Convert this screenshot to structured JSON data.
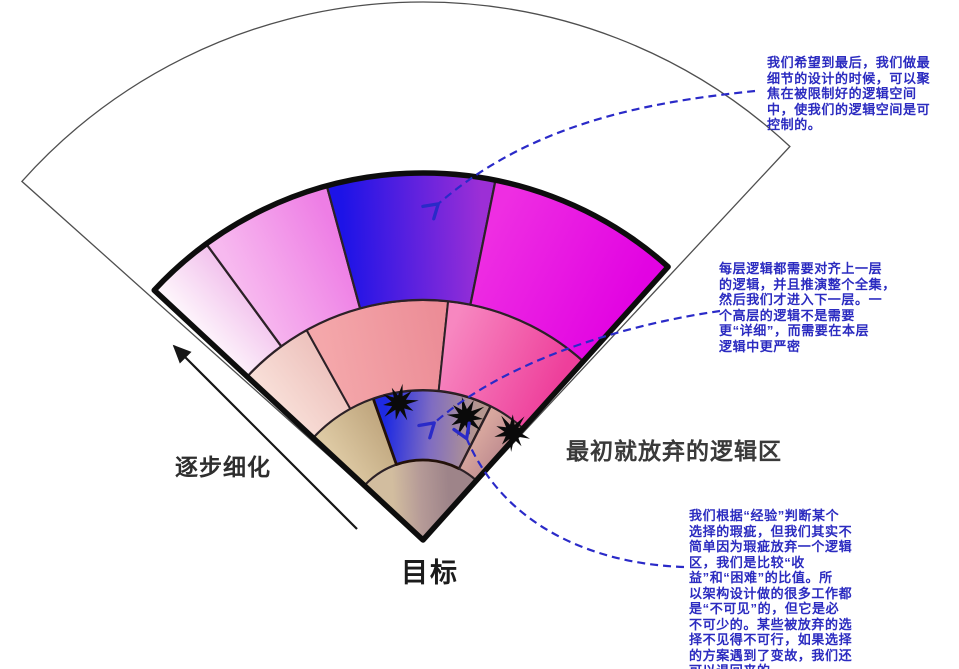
{
  "labels": {
    "refine": "逐步细化",
    "goal": "目标",
    "abandoned": "最初就放弃的逻辑区"
  },
  "annotations": [
    {
      "text": "我们希望到最后，我们做最\n细节的设计的时候，可以聚\n焦在被限制好的逻辑空间\n中，使我们的逻辑空间是可\n控制的。"
    },
    {
      "text": "每层逻辑都需要对齐上一层\n的逻辑，并且推演整个全集，\n然后我们才进入下一层。一\n个高层的逻辑不是需要\n更“详细”，而需要在本层\n逻辑中更严密"
    },
    {
      "text": "我们根据“经验”判断某个\n选择的瑕疵，但我们其实不\n简单因为瑕疵放弃一个逻辑\n区，我们是比较“收\n益”和“困难”的比值。所\n以架构设计做的很多工作都\n是“不可见”的，但它是必\n不可少的。某些被放弃的选\n择不见得不可行，如果选择\n的方案遇到了变故，我们还\n可以退回来的。"
    }
  ],
  "colors": {
    "annotation_blue": "#2b2bc0",
    "callout_dash_blue": "#2a2ac8",
    "fan_outline_black": "#0d0d0d",
    "white_fan_stroke": "#4f4f4f"
  },
  "diagram": {
    "apex": {
      "x": 423,
      "y": 540
    },
    "white_fan": {
      "a0": 47.0,
      "a1": 138.2,
      "r": 538,
      "fill": "#ffffff",
      "stroke": "#4f4f4f",
      "stroke_width": 1.3
    },
    "fan": {
      "a0": 48.1,
      "a1": 137.1,
      "r_outer": 367,
      "outline_color": "#0d0d0d",
      "outline_width": 5.5
    },
    "rings": [
      {
        "r_inner": 0,
        "r_outer": 80,
        "stroke": "#2c2127",
        "stroke_width": 2,
        "segments": [
          {
            "a0": 48.1,
            "a1": 137.1,
            "stops": [
              "#d2bd9f",
              "#b59a97",
              "#9e8489"
            ]
          }
        ]
      },
      {
        "r_inner": 80,
        "r_outer": 150,
        "stroke": "#2c2127",
        "stroke_width": 2,
        "segments": [
          {
            "a0": 109.4,
            "a1": 137.1,
            "stops": [
              "#ddc9a3",
              "#c2a981"
            ]
          },
          {
            "a0": 63.1,
            "a1": 109.4,
            "stops": [
              "#1e2ae2",
              "#7f6cc2",
              "#b4968f"
            ],
            "outline": {
              "color": "#231109",
              "width": 2.8
            }
          },
          {
            "a0": 48.1,
            "a1": 63.1,
            "stops": [
              "#d8a79e",
              "#c18e91"
            ]
          }
        ]
      },
      {
        "r_inner": 150,
        "r_outer": 240,
        "stroke": "#2c2127",
        "stroke_width": 2,
        "segments": [
          {
            "a0": 119.0,
            "a1": 137.1,
            "stops": [
              "#f8ded7",
              "#eec4bf"
            ]
          },
          {
            "a0": 84.0,
            "a1": 119.0,
            "stops": [
              "#f4a7aa",
              "#ec8d97"
            ]
          },
          {
            "a0": 48.1,
            "a1": 84.0,
            "stops": [
              "#f787c0",
              "#ee3f9b"
            ]
          }
        ]
      },
      {
        "r_inner": 240,
        "r_outer": 367,
        "stroke": "#2c2127",
        "stroke_width": 2.2,
        "segments": [
          {
            "a0": 126.2,
            "a1": 137.1,
            "stops": [
              "#fdf4fb",
              "#f3c6ee"
            ]
          },
          {
            "a0": 105.2,
            "a1": 126.2,
            "stops": [
              "#f7b9ef",
              "#ee7ee5"
            ]
          },
          {
            "a0": 78.6,
            "a1": 105.2,
            "stops": [
              "#1d13e7",
              "#9c2fd6"
            ]
          },
          {
            "a0": 48.1,
            "a1": 78.6,
            "stops": [
              "#ee2ee2",
              "#e203e2"
            ]
          }
        ]
      }
    ],
    "stars": [
      {
        "cx": 399,
        "cy": 403,
        "r": 20,
        "seed": 1
      },
      {
        "cx": 466,
        "cy": 417,
        "r": 21,
        "seed": 4
      },
      {
        "cx": 512,
        "cy": 432,
        "r": 20,
        "seed": 7
      }
    ],
    "star_color": "#0a0a0a",
    "callout_style": {
      "color": "#2a2ac8",
      "width": 2.2,
      "dash": "8 5"
    },
    "callout_arrows": [
      {
        "path": "M755,91 C660,101 535,119 437,205"
      },
      {
        "path": "M720,311 C636,323 510,356 433,424"
      },
      {
        "path": "M684,567 C596,564 504,528 466,437"
      }
    ],
    "refine_arrow": {
      "x1": 357,
      "y1": 529,
      "x2": 174,
      "y2": 346,
      "color": "#161616",
      "width": 2.2
    }
  }
}
